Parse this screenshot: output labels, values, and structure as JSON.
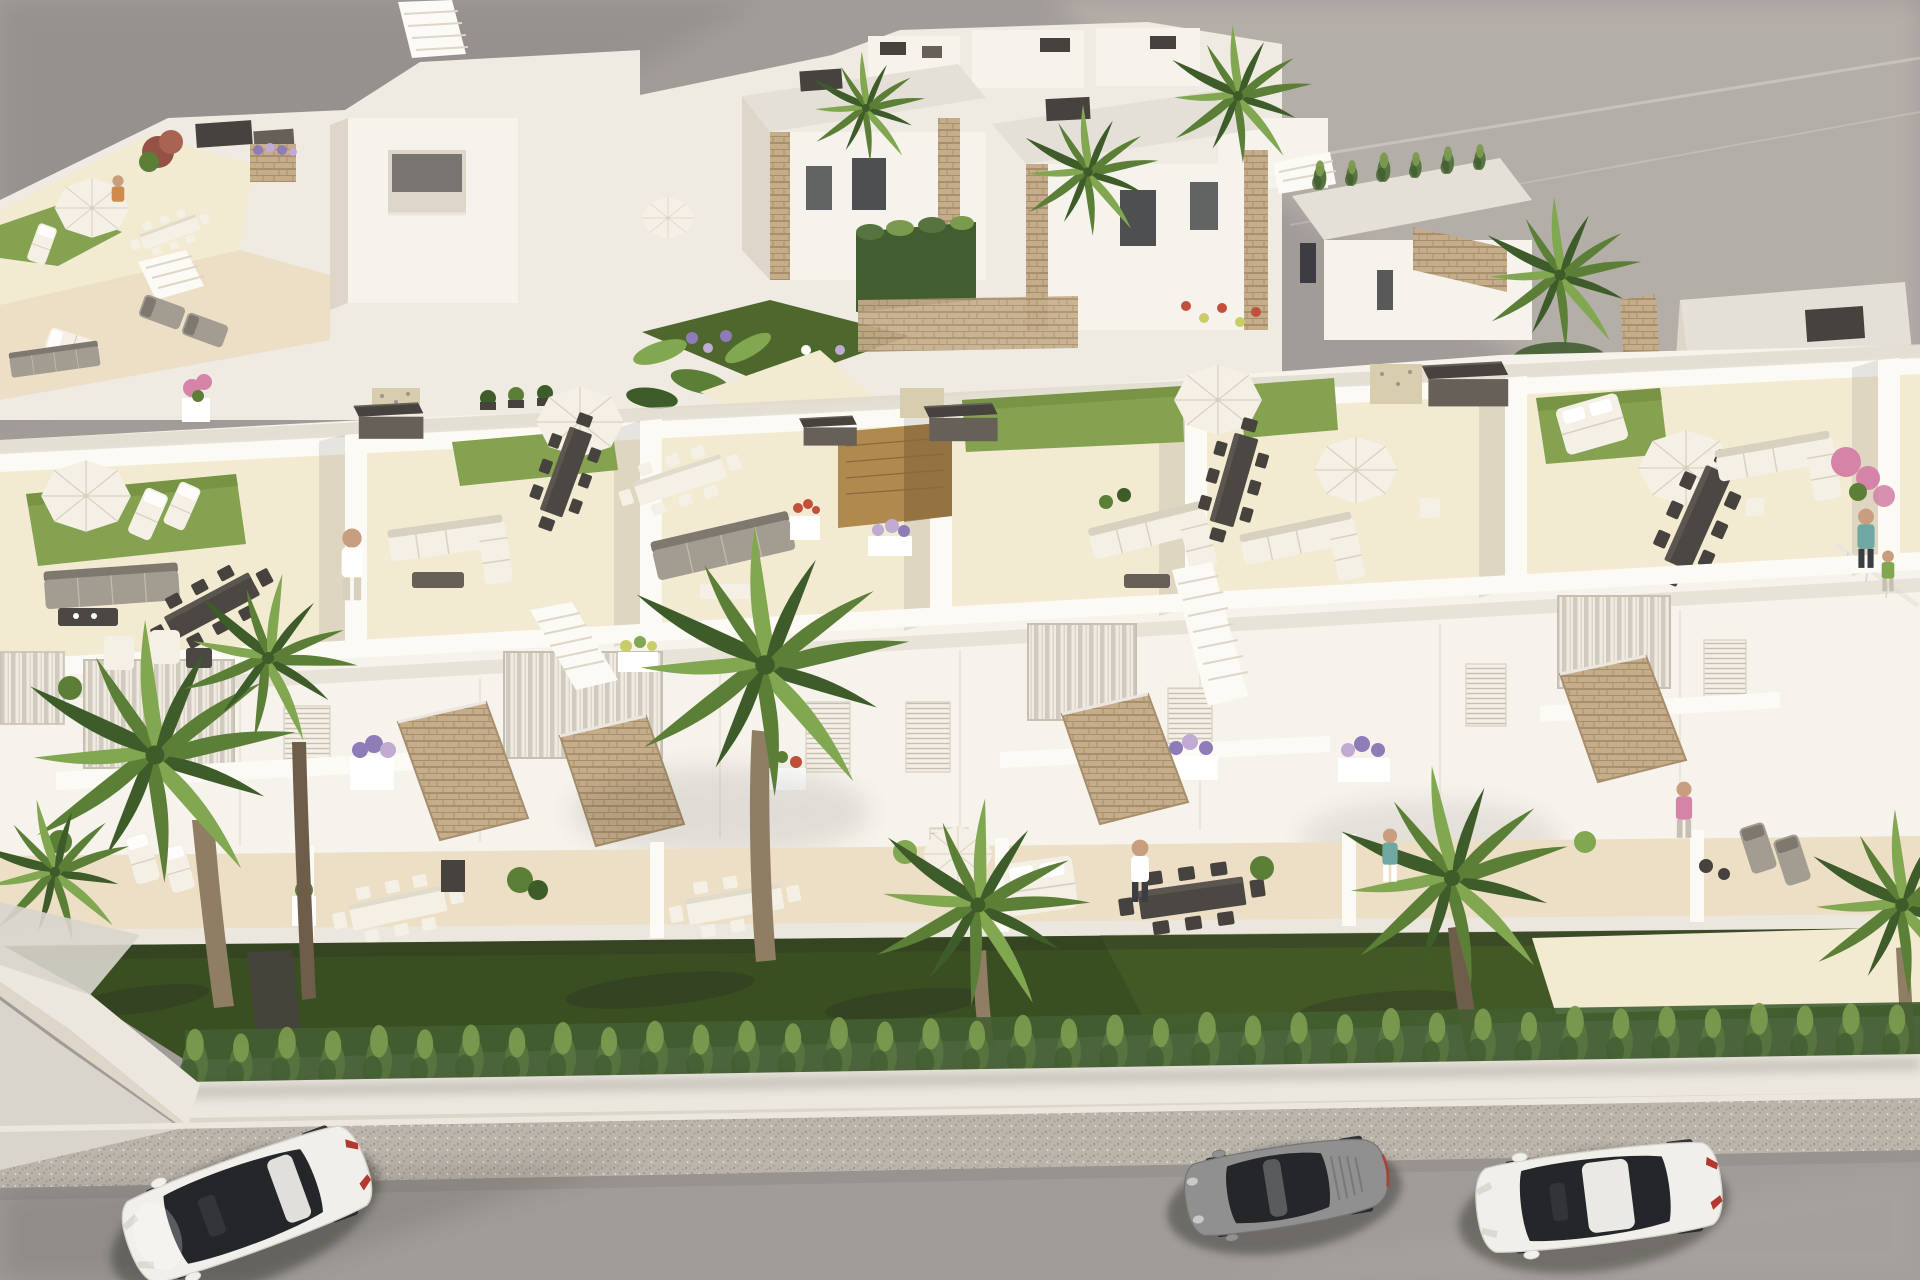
{
  "scene": {
    "title": "Aerial 3D architectural rendering of a white modern residential complex",
    "description": "Bird's-eye daytime render of a row of white Mediterranean townhouses with rooftop solarium terraces (artificial grass patches, white parasols, corner sofas, long dining tables, sun loungers, stone-clad stair bulkheads), upper terraces with flower planters, ground-floor dining terraces, a dark green front lawn bordered by a cypress hedge and low white wall, a speckled sidewalk, and a gray street with three parked cars. More white villas with palm trees and gardens fill the upper-left and upper-center; a row of flat-roofed houses sits upper-right on bare gray ground.",
    "time_of_day": "day",
    "style": "photorealistic CGI"
  },
  "palette": {
    "bg1": "#8d8886",
    "bg2": "#a29c99",
    "bg3": "#bcb6b0",
    "wallWhite": "#f6f3ec",
    "wallBright": "#fcfaf4",
    "wallLight": "#efebe2",
    "wallShade": "#ddd6c9",
    "wallDark": "#c7c0b2",
    "floorCream": "#ecdfc5",
    "floorLight": "#f3ead2",
    "floorShade": "#d9cdaf",
    "roofGray": "#e5e0d7",
    "roofDark": "#d0cabd",
    "grassRoof": "#84a24f",
    "grassRoofDark": "#6d8a3e",
    "lawn": "#394f21",
    "lawnLight": "#4e672c",
    "hedge": "#577440",
    "hedgeLight": "#7a9a4e",
    "hedgeDark": "#425e31",
    "palm1": "#3e5c29",
    "palm2": "#5c7f37",
    "palm3": "#82a751",
    "trunk": "#8f7d64",
    "trunkDark": "#6e5e49",
    "stone": "#c6ad8a",
    "stoneDark": "#a78e6c",
    "wood": "#b0894f",
    "woodDark": "#8a683c",
    "box": "#46423e",
    "boxLight": "#666058",
    "furnW": "#f4f0e6",
    "furnWShade": "#d9d1c0",
    "furnG": "#a29c91",
    "furnGDark": "#7e786e",
    "tableDark": "#4b4743",
    "tableWood": "#705d3f",
    "glass": "#24262a",
    "glassLight": "#3a3d42",
    "road": "#a09c99",
    "roadDark": "#8d8986",
    "walk": "#bab4ab",
    "walkDot": "#9c968c",
    "curb": "#ebe7de",
    "apron": "#d9d5cd",
    "carW": "#f1efea",
    "carWShade": "#d3d0ca",
    "carG": "#909090",
    "carGDark": "#747473",
    "red": "#b23830",
    "purple": "#8d7cb8",
    "lilac": "#c0abd2",
    "pink": "#d584a8",
    "flRed": "#c2503c",
    "flYellow": "#c9cc67",
    "white": "#ffffff",
    "skin": "#c89e7f",
    "shadow": "#2c2924",
    "teal": "#6fa8a2",
    "orange": "#cf8a4e"
  },
  "objects": {
    "street": {
      "parked_cars": 3,
      "sidewalk": true,
      "low_white_wall": true,
      "cypress_hedge_plants": 38,
      "front_lawn": "dark green"
    },
    "vehicles": [
      {
        "id": "car-white-left",
        "style": "white crossover with panoramic glass roof",
        "position": "bottom-left lane, angled"
      },
      {
        "id": "car-gray-center",
        "style": "gray sports coupe",
        "position": "bottom-center-right lane"
      },
      {
        "id": "car-white-right",
        "style": "white sedan with dark glass roof",
        "position": "bottom-right lane"
      }
    ],
    "foreground_building": {
      "rooftop_terraces": 6,
      "amenities": [
        "white parasols",
        "artificial grass patches",
        "white corner sofas",
        "gray lounge sets",
        "long dining tables",
        "sun loungers",
        "day beds",
        "stair bulkheads with stone cladding",
        "flower planters",
        "glass railings"
      ]
    },
    "background": {
      "villa_cluster_upper_left": true,
      "villa_cluster_upper_center": true,
      "house_row_upper_right": true
    },
    "vegetation": {
      "fan_palms_foreground": 7,
      "fan_palms_background": 6,
      "cypress_hedge_row": true,
      "flower_colors": [
        "purple",
        "lilac",
        "pink",
        "red",
        "yellow",
        "white"
      ]
    },
    "people_visible": 7
  }
}
